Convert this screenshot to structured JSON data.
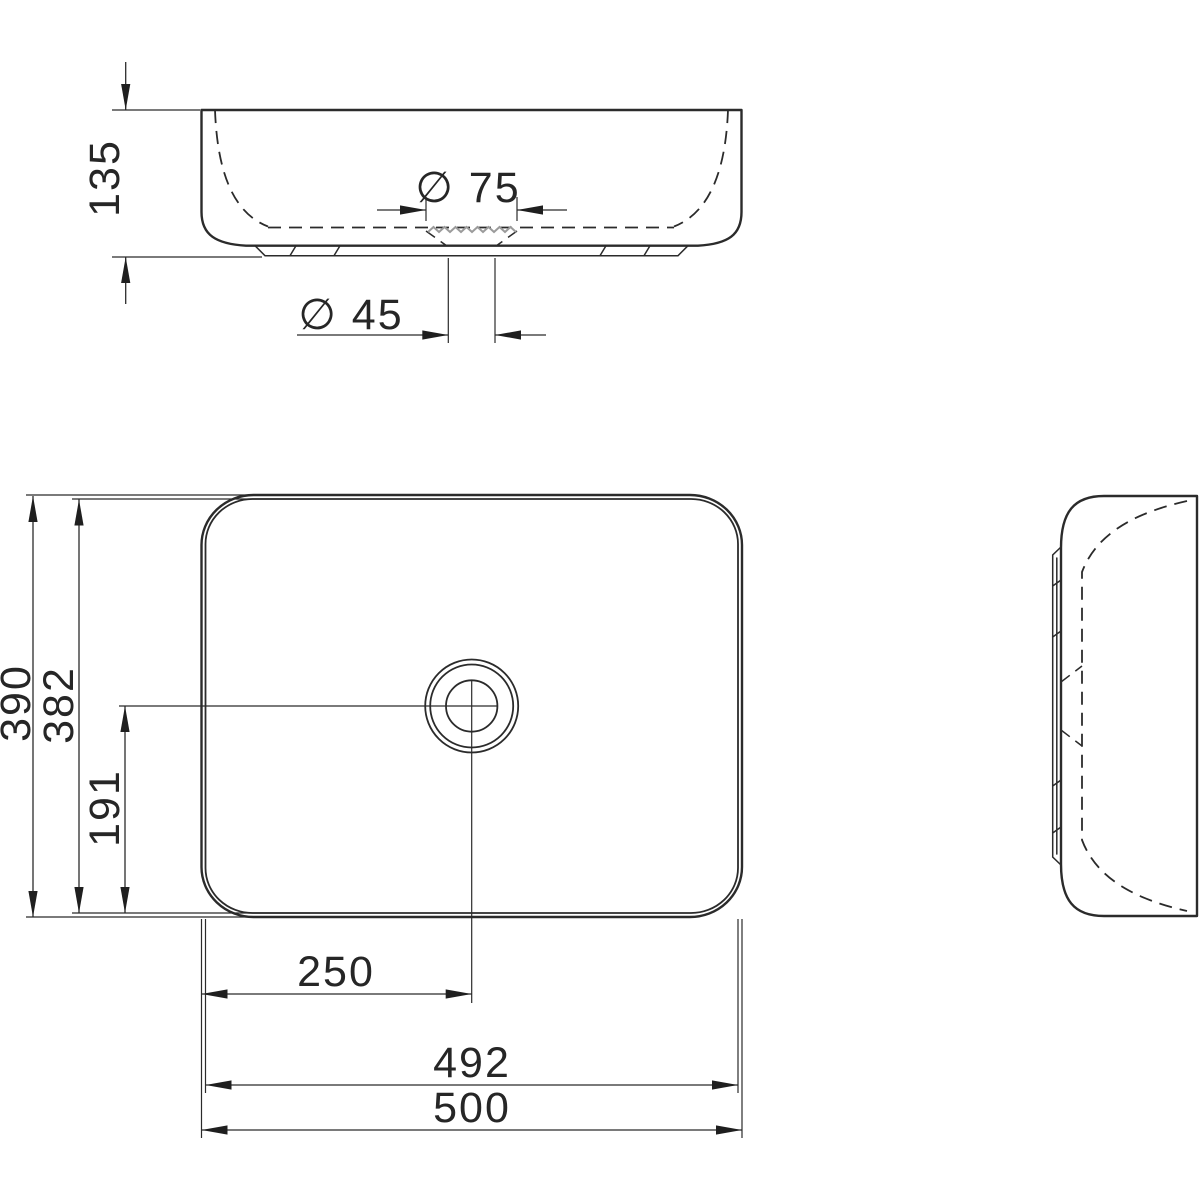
{
  "drawing_type": "technical-dimension-drawing",
  "subject": "rectangular countertop washbasin, three orthographic views",
  "colors": {
    "line": "#2b2b2b",
    "dimension_line": "#2b2b2b",
    "text": "#262626",
    "recess_hatch_gray": "#9b9b9b",
    "background": "#ffffff"
  },
  "views": {
    "front": {
      "name": "front-elevation",
      "dimensions": [
        {
          "id": "overall-height",
          "label": "135"
        },
        {
          "id": "drain-recess-diameter",
          "label": "∅ 75"
        },
        {
          "id": "drain-hole-diameter",
          "label": "∅ 45"
        }
      ]
    },
    "plan": {
      "name": "top-view",
      "dimensions": [
        {
          "id": "overall-depth",
          "label": "390"
        },
        {
          "id": "inner-depth",
          "label": "382"
        },
        {
          "id": "drain-center-from-bottom-edge",
          "label": "191"
        },
        {
          "id": "drain-center-from-left-edge",
          "label": "250"
        },
        {
          "id": "inner-width",
          "label": "492"
        },
        {
          "id": "overall-width",
          "label": "500"
        }
      ]
    },
    "side": {
      "name": "side-elevation",
      "dimensions": []
    }
  }
}
